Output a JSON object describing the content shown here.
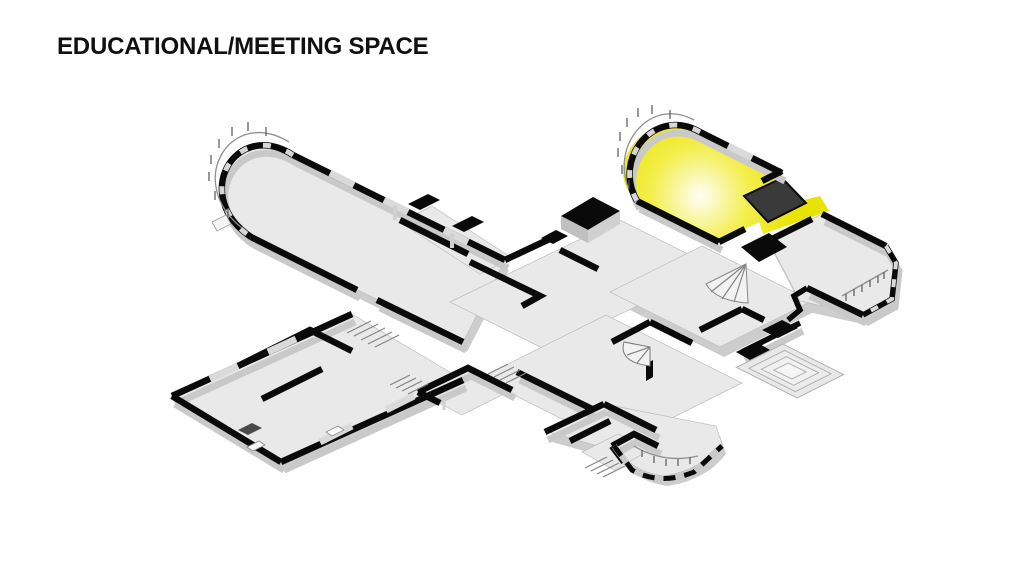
{
  "title": {
    "text": "EDUCATIONAL/MEETING SPACE"
  },
  "floor_plan": {
    "type": "axonometric cutaway floor plan of a mansion",
    "highlighted_room": {
      "label": "Educational/Meeting Space",
      "highlight_color": "#e9e300",
      "glow_center_color": "#fffef6"
    },
    "colors": {
      "walls": "#0a0a0a",
      "floor": "#e9e9e9",
      "wall_faces": "#c9c9c9",
      "background": "#ffffff",
      "title": "#101010"
    }
  }
}
